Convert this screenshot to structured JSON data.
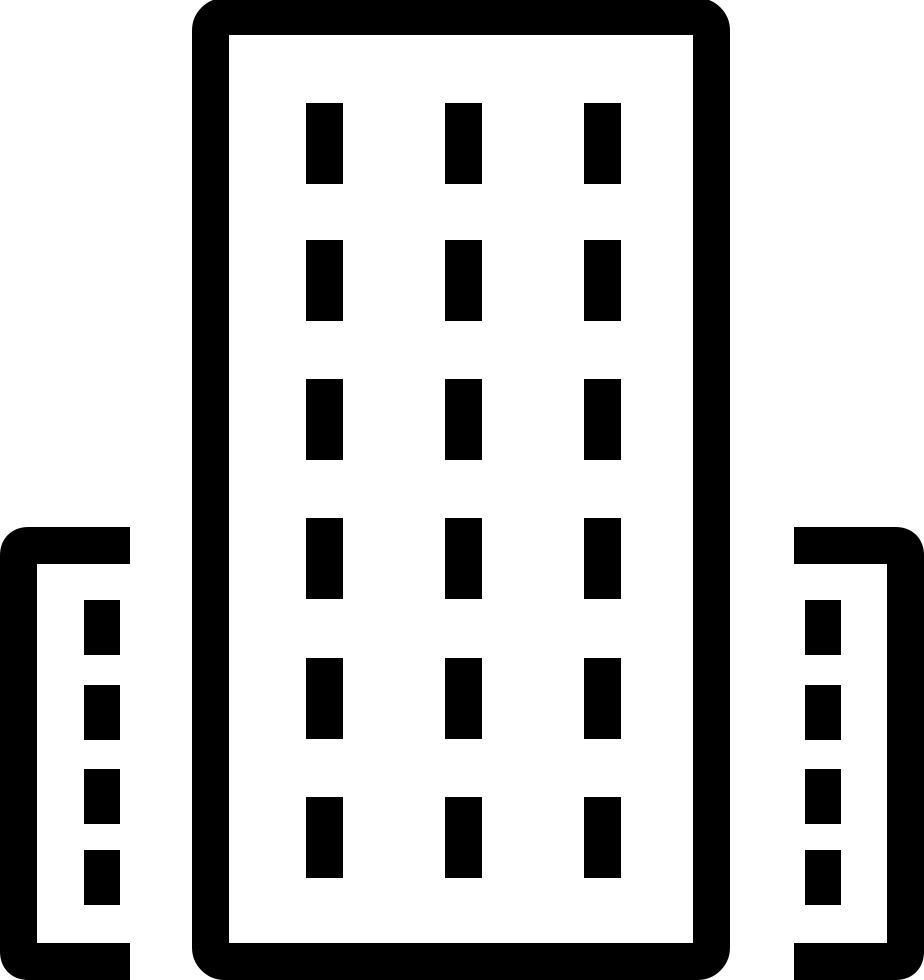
{
  "page": {
    "background_color": "#ffffff"
  },
  "icon": {
    "name": "office-building-icon",
    "color": "#000000",
    "canvas": {
      "width": 924,
      "height": 980
    },
    "tower": {
      "outline": {
        "x": 210.5,
        "y": 16.5,
        "width": 501,
        "height": 945,
        "corner_radius": 14,
        "stroke_width": 37
      },
      "windows": {
        "col_x": [
          306,
          445,
          584
        ],
        "row_y": [
          103,
          240,
          379,
          518,
          658,
          797
        ],
        "width": 37,
        "height": 81
      }
    },
    "wings": [
      {
        "id": "left-wing",
        "edge_x": 0,
        "open_x": 130,
        "top_y": 527,
        "bottom_y": 980,
        "stroke_width": 37,
        "corner_radius": 10,
        "windows": {
          "x": 84,
          "row_y": [
            600,
            685,
            769,
            850
          ],
          "width": 36,
          "height": 55
        }
      },
      {
        "id": "right-wing",
        "edge_x": 924,
        "open_x": 794,
        "top_y": 527,
        "bottom_y": 980,
        "stroke_width": 37,
        "corner_radius": 10,
        "windows": {
          "x": 805,
          "row_y": [
            600,
            685,
            769,
            850
          ],
          "width": 36,
          "height": 55
        }
      }
    ]
  }
}
